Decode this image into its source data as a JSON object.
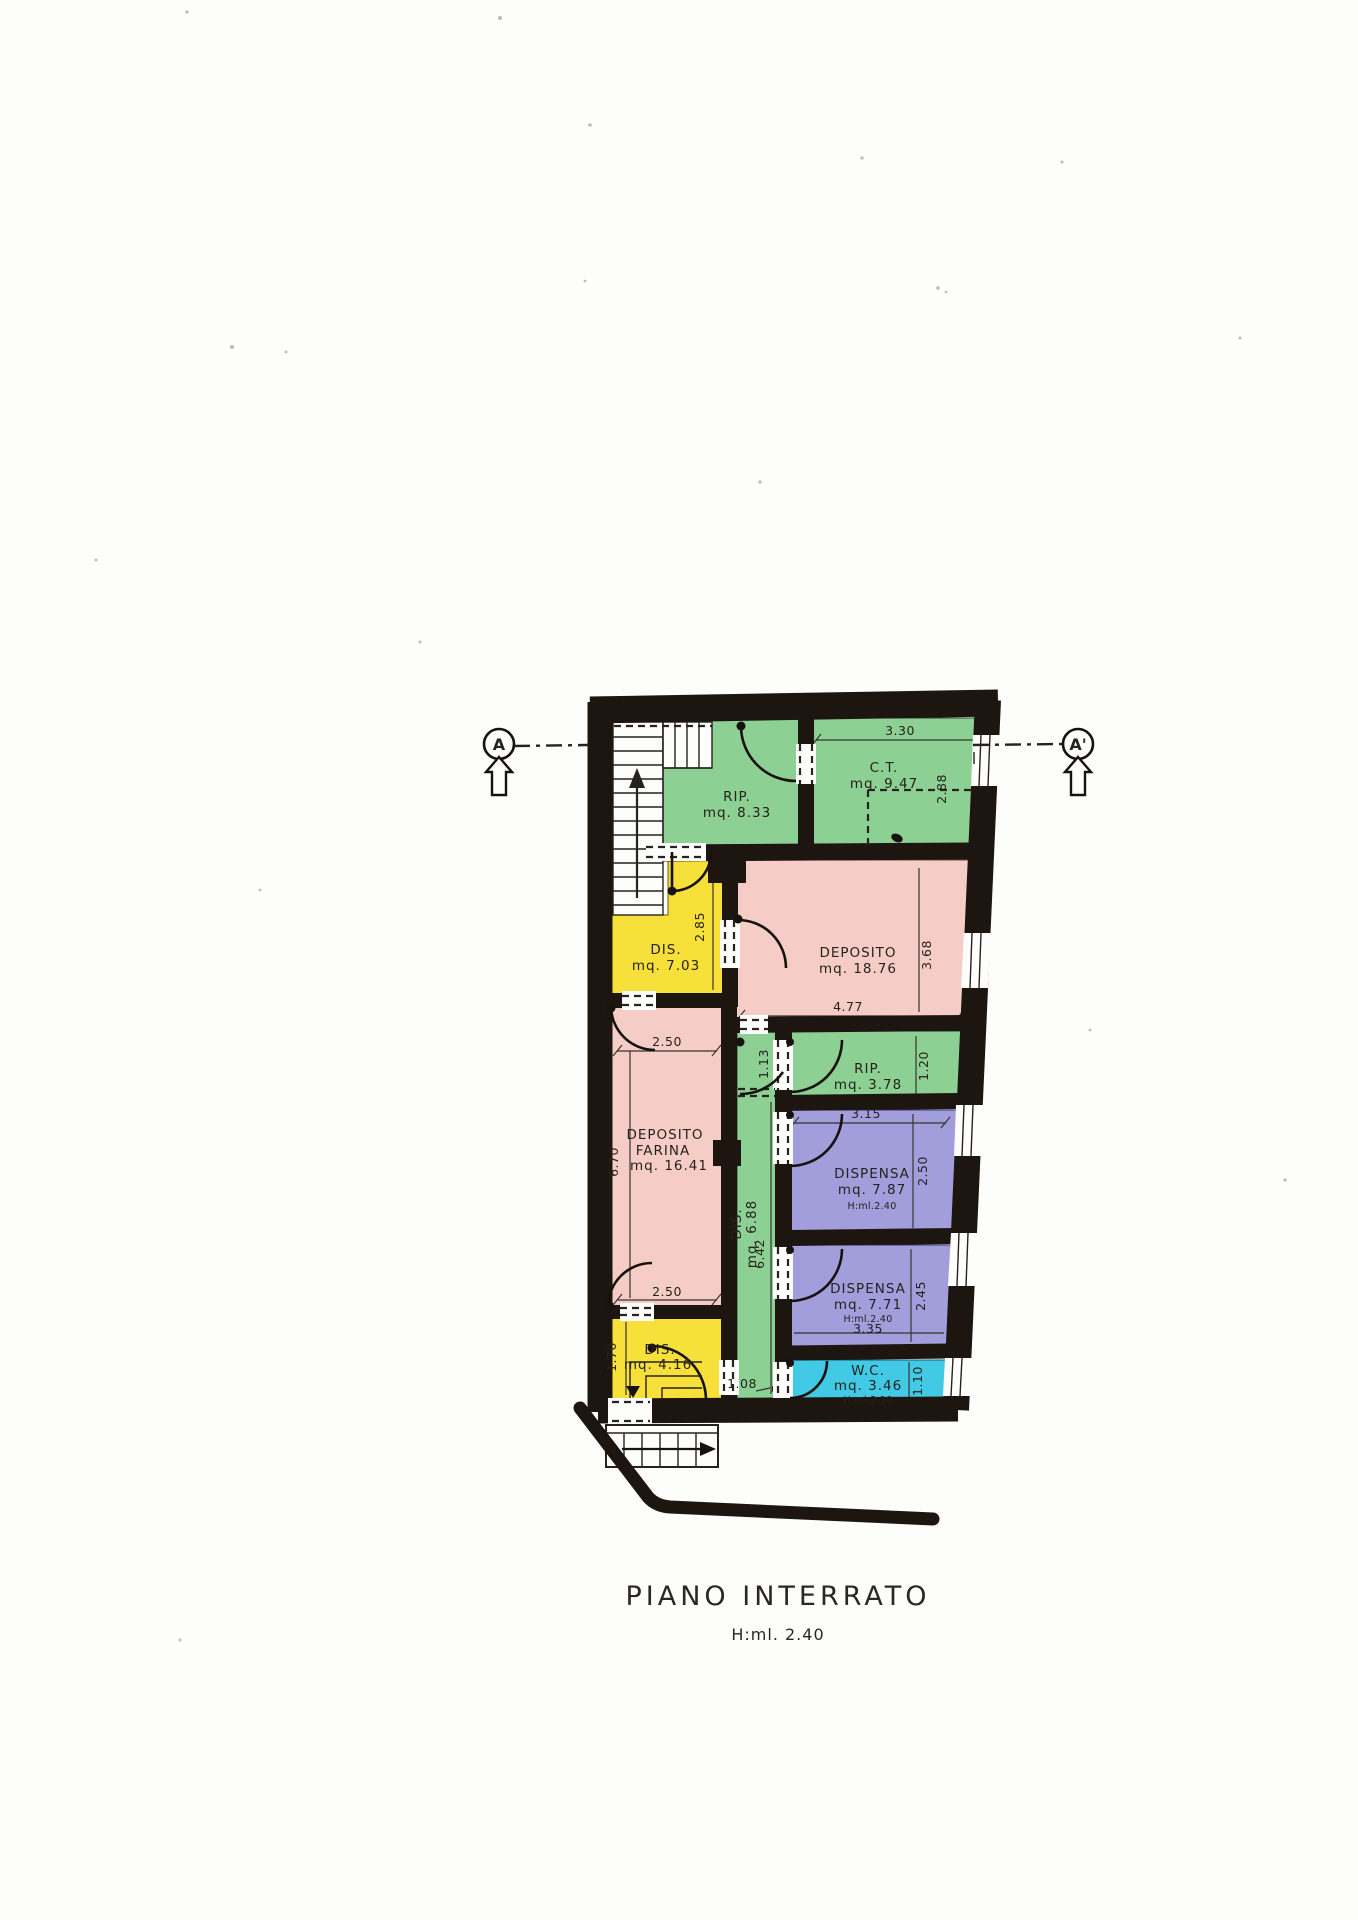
{
  "footer": {
    "title": "PIANO INTERRATO",
    "subtitle": "H:ml. 2.40"
  },
  "section_markers": {
    "left": "A",
    "right": "A'"
  },
  "rooms": {
    "rip1": {
      "name": "RIP.",
      "area": "mq. 8.33"
    },
    "ct": {
      "name": "C.T.",
      "area": "mq. 9.47"
    },
    "dis1": {
      "name": "DIS.",
      "area": "mq. 7.03"
    },
    "deposito": {
      "name": "DEPOSITO",
      "area": "mq. 18.76"
    },
    "rip2": {
      "name": "RIP.",
      "area": "mq. 3.78"
    },
    "farina": {
      "line1": "DEPOSITO",
      "line2": "FARINA",
      "area": "mq. 16.41"
    },
    "corridor": {
      "name": "DIS.",
      "area": "mq. 6.88"
    },
    "dispensa1": {
      "name": "DISPENSA",
      "area": "mq. 7.87",
      "height": "H:ml.2.40"
    },
    "dispensa2": {
      "name": "DISPENSA",
      "area": "mq. 7.71",
      "height": "H:ml.2.40"
    },
    "wc": {
      "name": "W.C.",
      "area": "mq. 3.46",
      "height": "H:ml.2.10"
    },
    "dis2": {
      "name": "DIS.",
      "area": "mq. 4.16"
    }
  },
  "dimensions": {
    "ct_width": "3.30",
    "ct_height": "2.88",
    "dis1_height": "2.85",
    "deposito_width": "4.77",
    "deposito_height": "3.68",
    "rip2_height": "1.20",
    "dispensa1_width": "3.15",
    "dispensa1_height": "2.50",
    "dispensa2_width": "3.35",
    "dispensa2_height": "2.45",
    "wc_height": "1.10",
    "farina_width_top": "2.50",
    "farina_width_bottom": "2.50",
    "farina_height": "6.70",
    "corridor_height": "6.42",
    "corridor_top_width": "1.13",
    "corridor_bottom_width": "1.08",
    "dis2_height": "1.70"
  },
  "colors": {
    "wall": "#1d1510",
    "green": "#8dd093",
    "pink": "#f6cdc6",
    "yellow": "#f8e03a",
    "purple": "#a29ddb",
    "cyan": "#41c9e5",
    "paper": "#fdfdfb"
  }
}
